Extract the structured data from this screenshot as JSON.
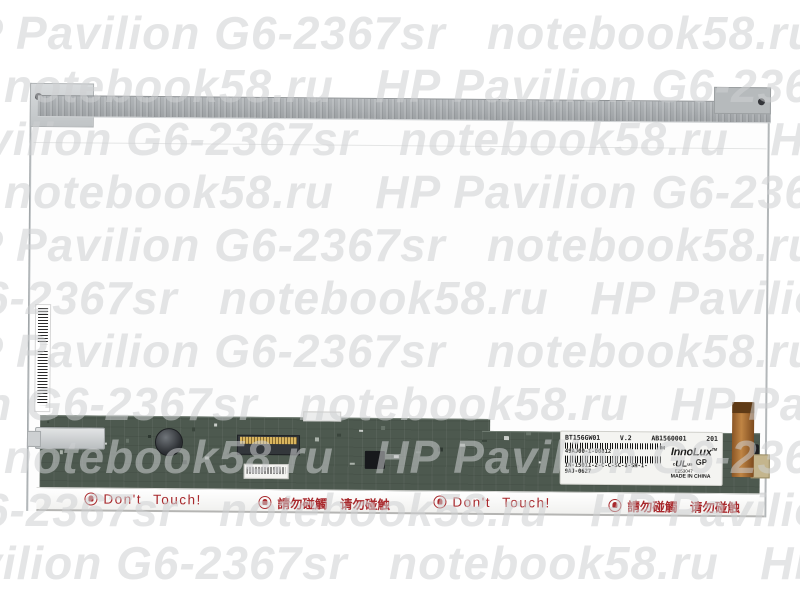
{
  "watermark": {
    "site": "notebook58.ru",
    "product": "HP Pavilion G6-2367sr"
  },
  "panel_photo": {
    "info_label": {
      "model": "BT156GW01",
      "version": "V.2",
      "serial": "AB1560001",
      "batch": "201",
      "code1": "49AJ00-1-00812",
      "code2": "IN-15011-2-C-C-SC-1-SH-1-9AJ-0627",
      "m_mark": "M",
      "brand": "InnoLux",
      "brand_tm": "TM",
      "ul_c": "c",
      "ul": "UL",
      "ul_us": "us",
      "grade": "GP",
      "ul_file": "E253047",
      "origin": "MADE IN CHINA"
    },
    "warning_en": "Don't Touch!",
    "warning_zh": "請勿碰觸　请勿碰触"
  }
}
